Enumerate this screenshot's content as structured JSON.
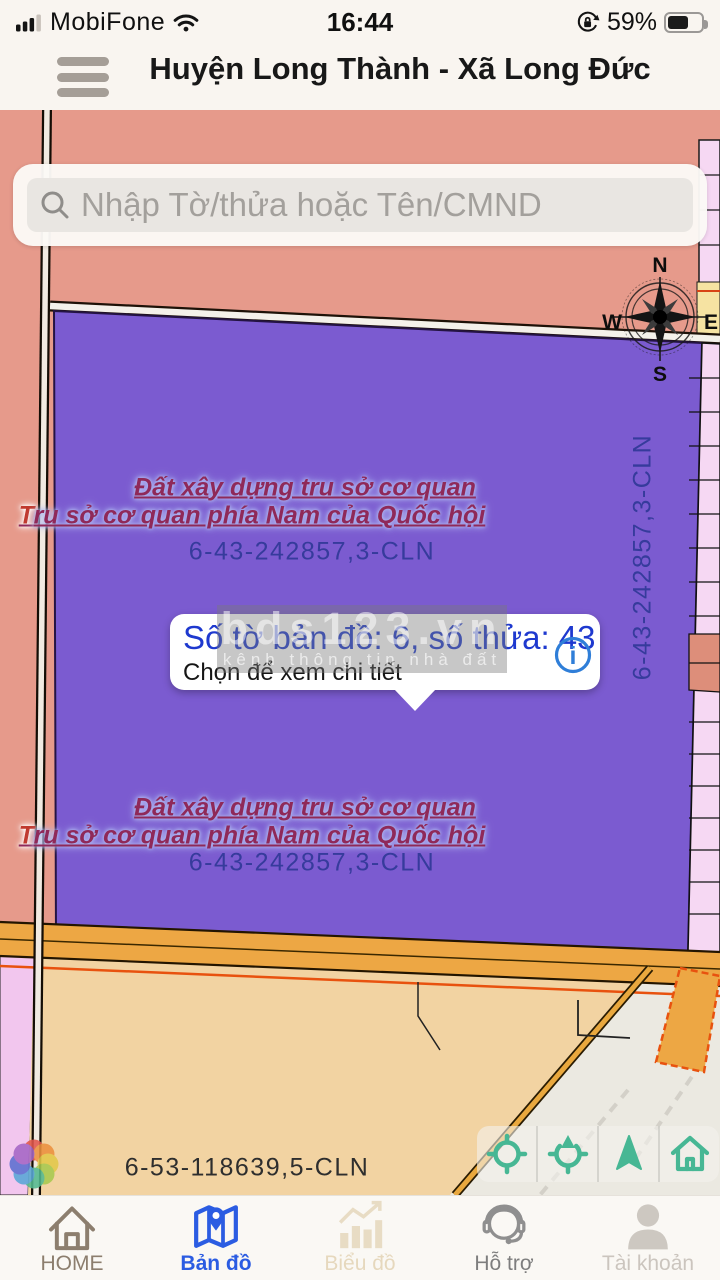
{
  "status_bar": {
    "carrier": "MobiFone",
    "time": "16:44",
    "battery_percent": "59%"
  },
  "header": {
    "title": "Huyện Long Thành - Xã Long Đức"
  },
  "search": {
    "placeholder": "Nhập Tờ/thửa hoặc Tên/CMND"
  },
  "compass": {
    "north": "N",
    "south": "S",
    "east": "E",
    "west": "W"
  },
  "map": {
    "parcel_name_line1": "Đất xây dựng tru sở cơ quan",
    "parcel_name_line2": "Tru sở cơ quan phía Nam của Quốc hội",
    "parcel_code": "6-43-242857,3-CLN",
    "parcel_code_vertical": "6-43-242857,3-CLN",
    "bottom_parcel_code": "6-53-118639,5-CLN"
  },
  "popup": {
    "title": "Số tờ bản đồ: 6, số thửa: 43",
    "subtitle": "Chọn để xem chi tiết",
    "info_glyph": "i"
  },
  "watermark": {
    "brand": "bds123.vn",
    "tagline": "kênh thông tin nhà đất"
  },
  "tab_bar": {
    "items": [
      {
        "label": "HOME"
      },
      {
        "label": "Bản đồ"
      },
      {
        "label": "Biểu đồ"
      },
      {
        "label": "Hỗ trợ"
      },
      {
        "label": "Tài khoản"
      }
    ],
    "active": "Bản đồ"
  },
  "colors": {
    "active_tab_blue": "#2b5ce2",
    "popup_text_blue": "#1e39cf",
    "control_teal": "#47b794",
    "parcel_purple": "#7b5bd0",
    "map_salmon": "#e69a8b",
    "road_orange": "#eda744"
  }
}
